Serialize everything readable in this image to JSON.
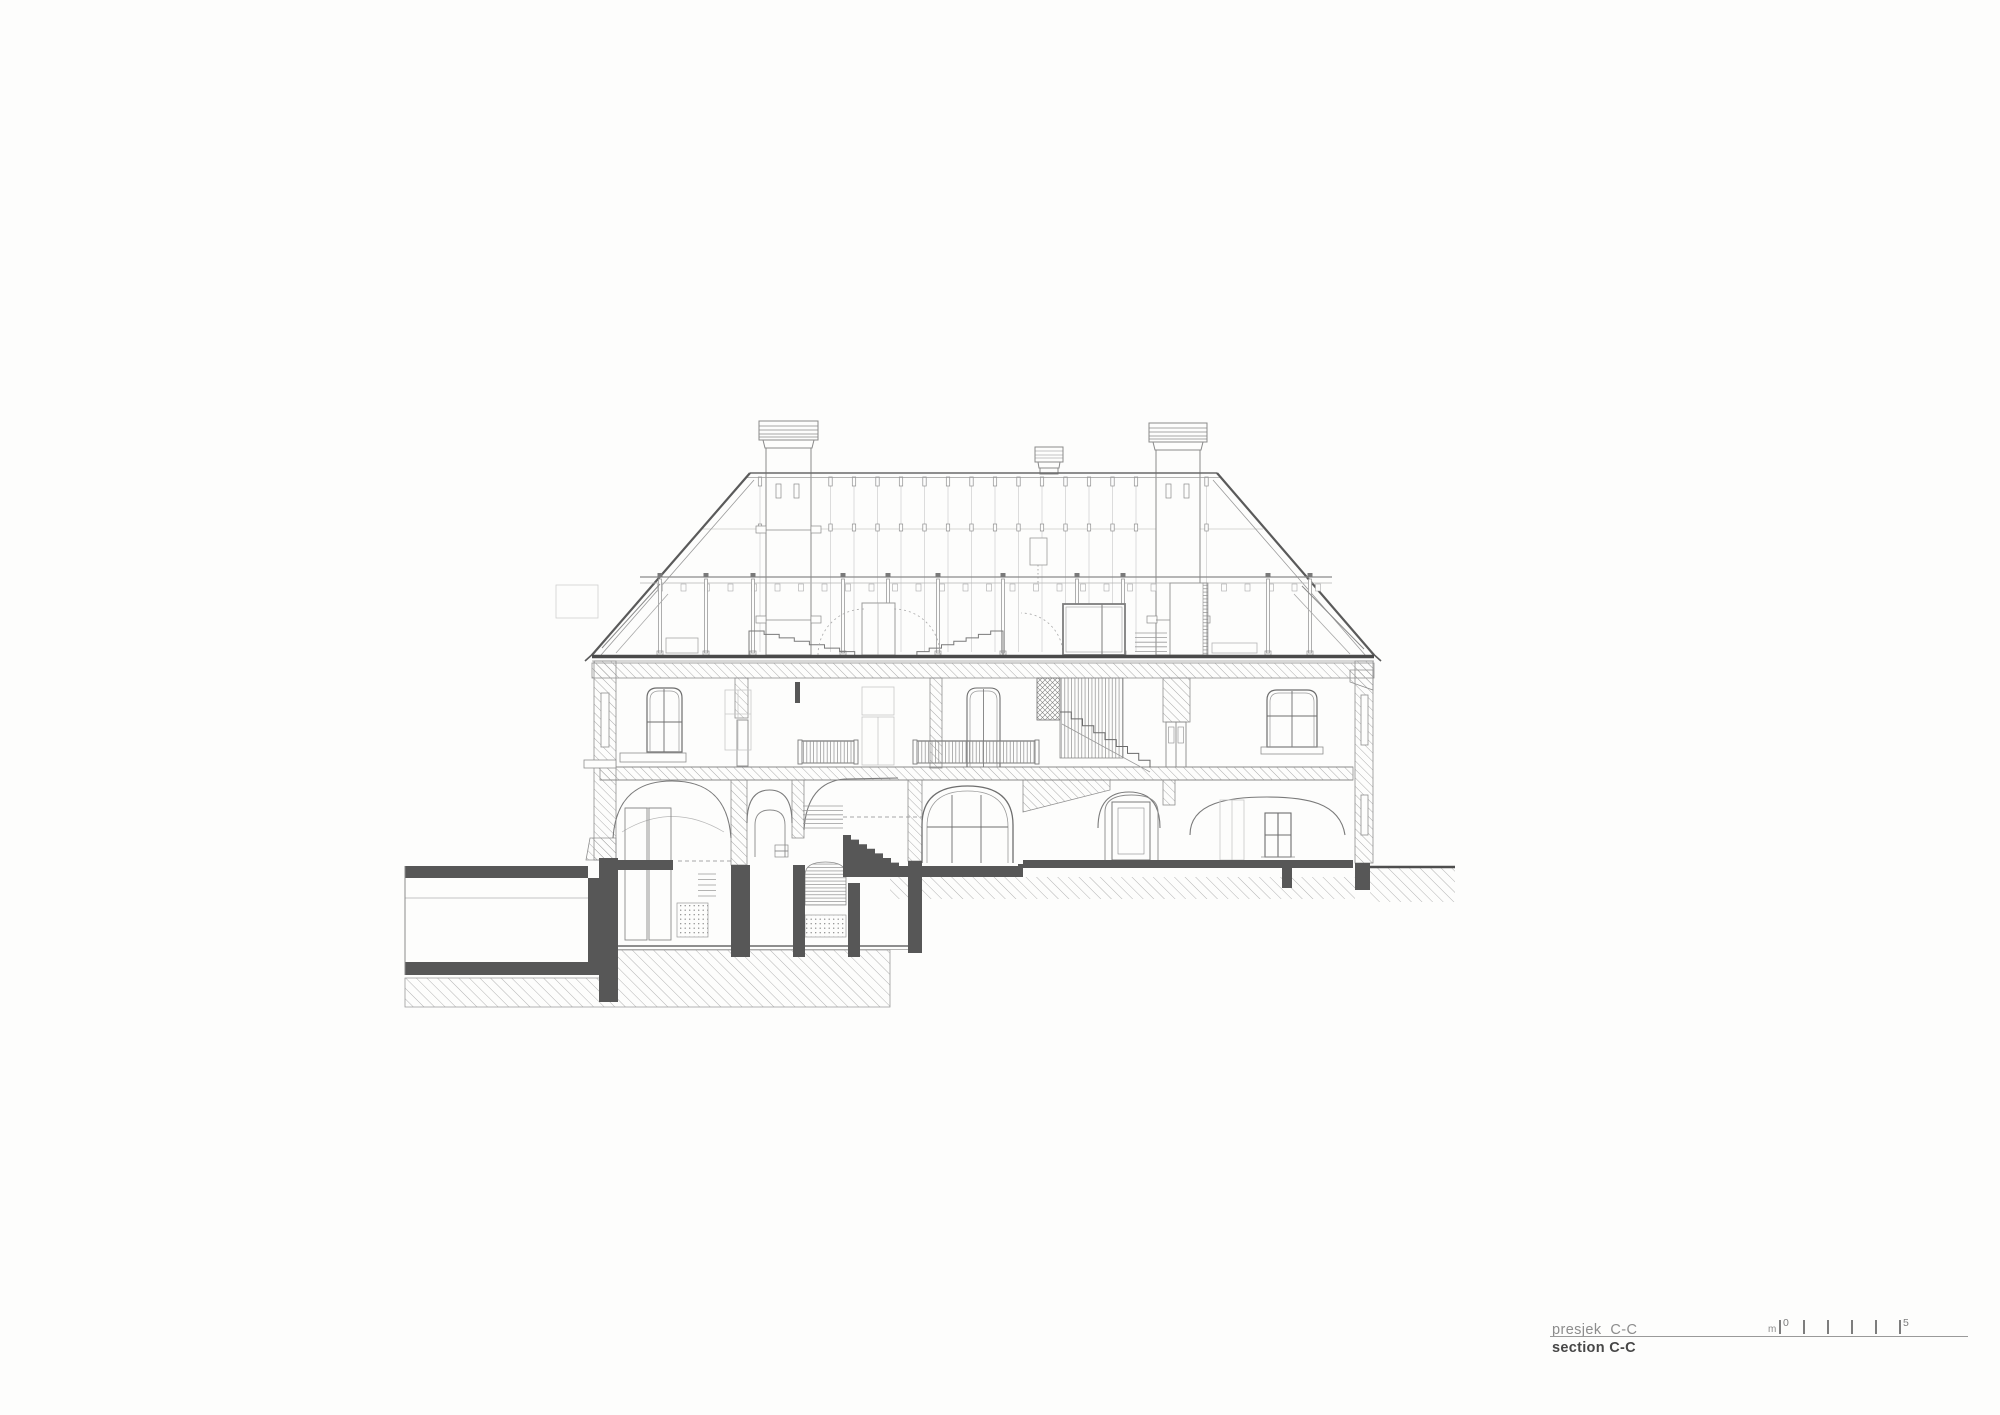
{
  "titleblock": {
    "title_local": "presjek  C-C",
    "title_english": "section C-C",
    "scale": {
      "unit": "m",
      "start_label": "0",
      "end_label": "5",
      "tick_count": 6,
      "tick_start_x": 1779,
      "tick_spacing_px": 24
    }
  },
  "drawing_meta": {
    "kind": "architectural-building-cross-section",
    "colors": {
      "paper": "#fdfdfc",
      "poche_dark": "#575757",
      "heavy_line": "#4e4e4e",
      "medium_line": "#7a7a7a",
      "light_line": "#9b9b9b",
      "faint_line": "#d2d2d2",
      "ghost_line": "#c7c7c7",
      "hatch_line": "#a3a3a3",
      "text_gray": "#8c8c8c",
      "text_dark": "#474747"
    }
  }
}
